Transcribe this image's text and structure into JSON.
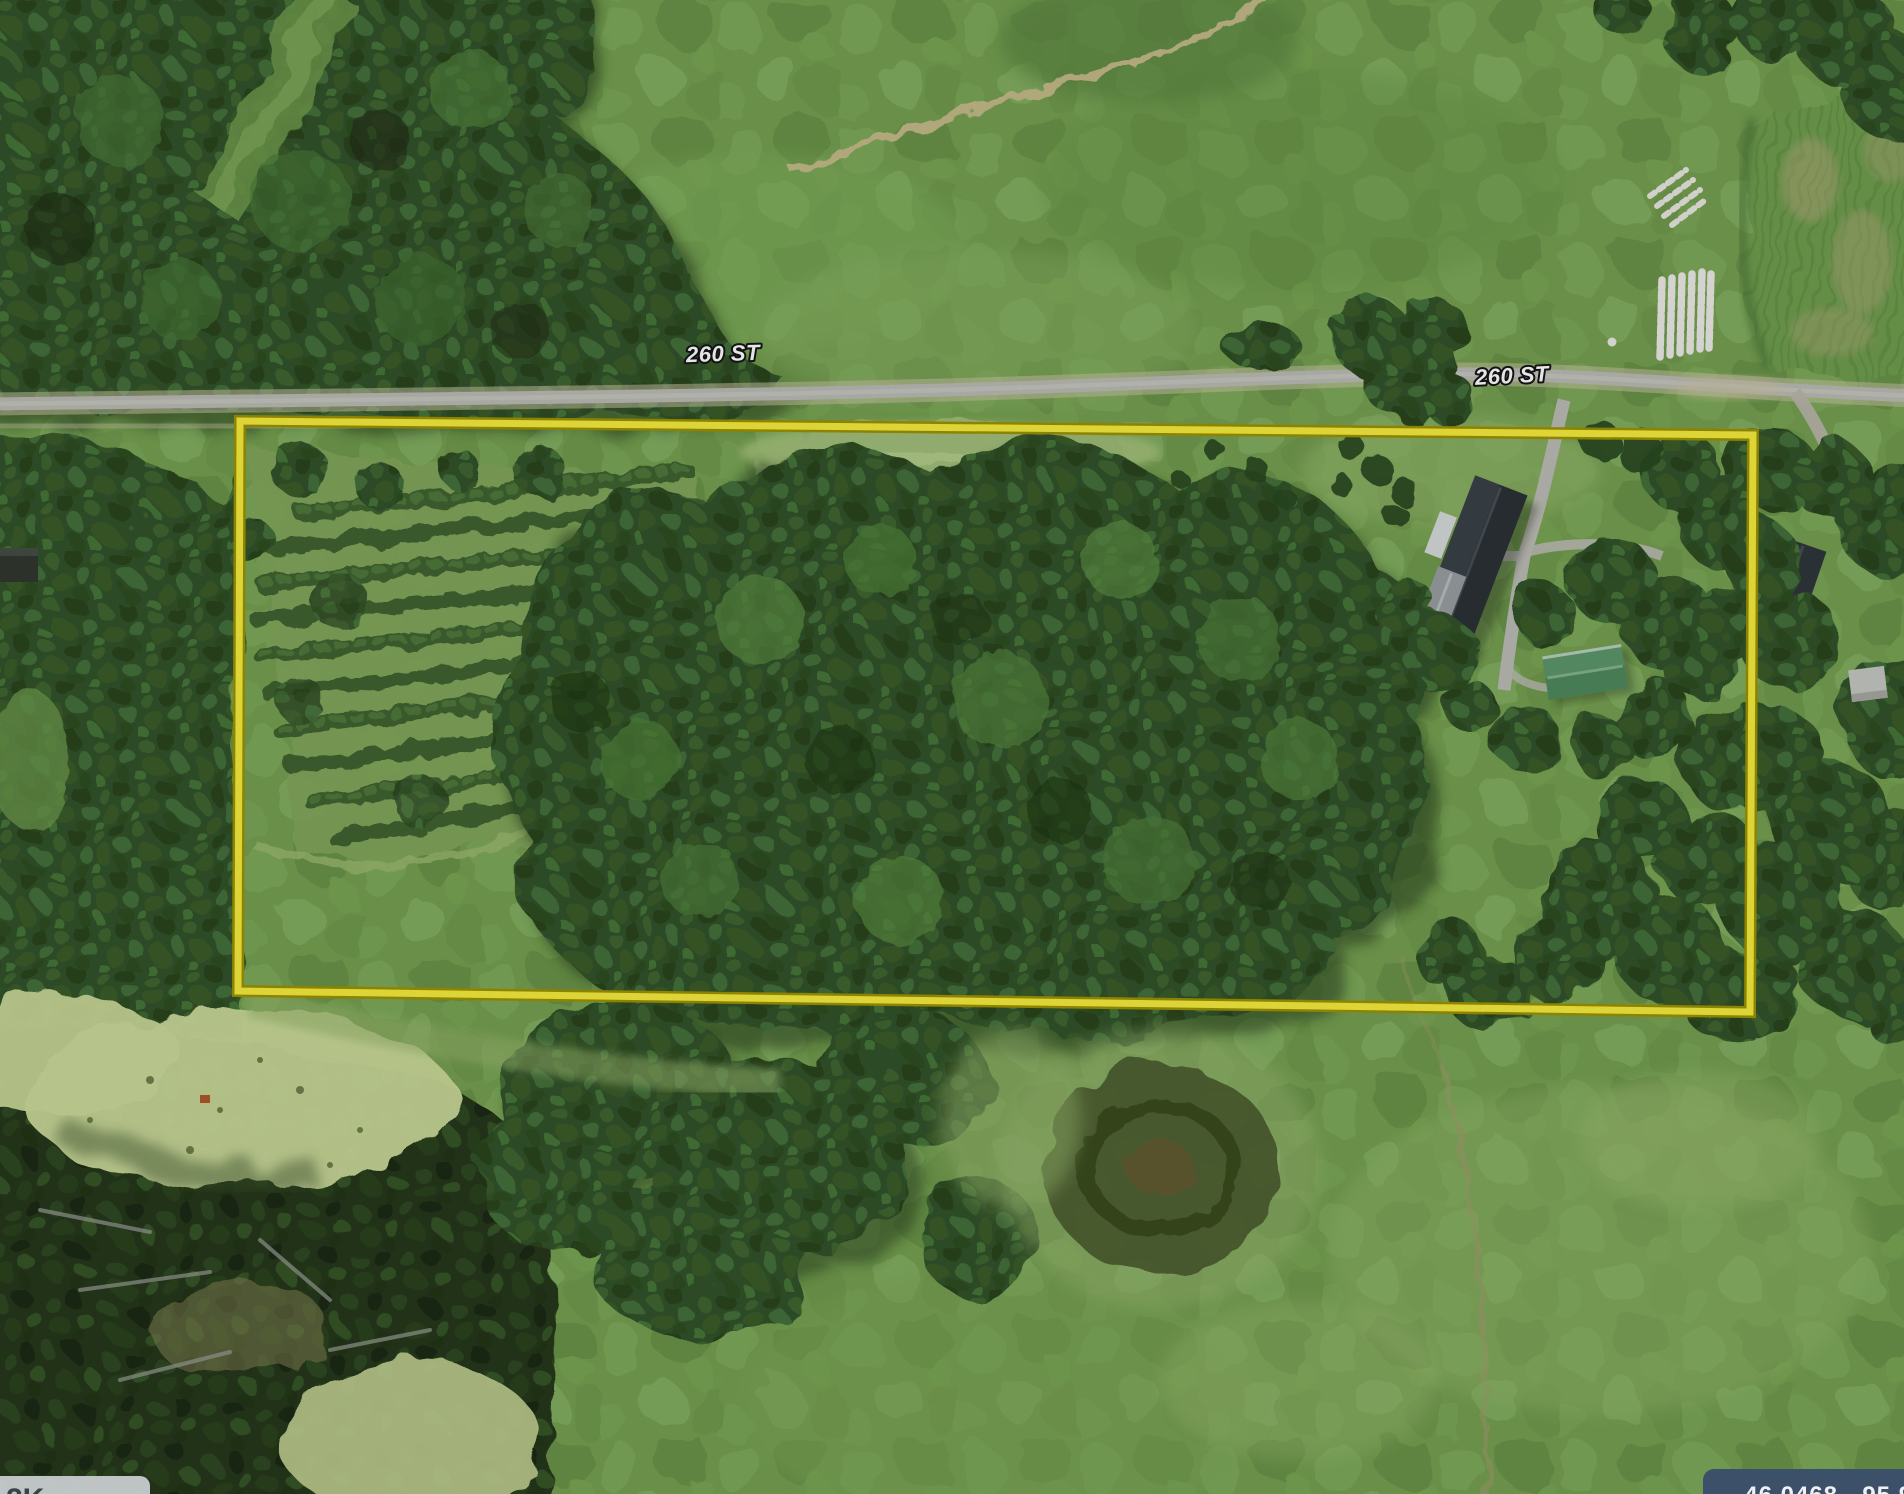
{
  "map": {
    "street_labels": [
      {
        "text": "260 ST"
      },
      {
        "text": "260 ST"
      }
    ],
    "coordinate_badge": {
      "text": "46.0468, -95.996"
    },
    "corner_badge": {
      "text": "2K"
    },
    "colors": {
      "parcel_outline": "#f6ec3e",
      "parcel_outline_edge": "#9e9203",
      "road": "#bcbcb5",
      "street_label_fill": "#ffffff",
      "street_label_outline": "#161616",
      "badge_bg": "#3d5069",
      "badge_text": "#eef1f5",
      "corner_badge_bg": "#c7cbcd",
      "corner_badge_text": "#3c4146"
    }
  }
}
